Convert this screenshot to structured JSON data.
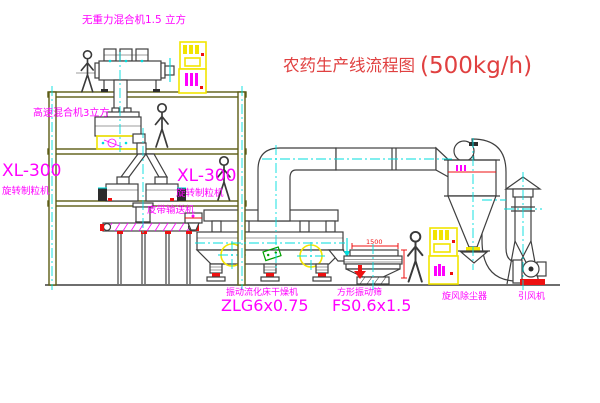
{
  "title": {
    "text_cn": "农药生产线流程图",
    "text_rate": "(500kg/h)"
  },
  "equipment_labels": {
    "top_mixer": "无重力混合机1.5 立方",
    "mid_mixer": "高速混合机3立方",
    "granulator_left_model": "XL-300",
    "granulator_left_name": "旋转制粒机",
    "granulator_center_model": "XL-300",
    "granulator_center_name": "旋转制粒机",
    "belt_conveyor": "皮带输送机",
    "dryer_name": "振动流化床干燥机",
    "dryer_model": "ZLG6x0.75",
    "sieve_name": "方形振动筛",
    "sieve_model": "FS0.6x1.5",
    "cyclone_name": "旋风除尘器",
    "fan_name": "引风机"
  },
  "dimensions": {
    "sieve_width": "1500"
  },
  "colors": {
    "background": "#ffffff",
    "line": "#3f3f3f",
    "building": "#5c5c14",
    "label": "#ff00ff",
    "title": "#e04040",
    "cad_yellow": "#f2e400",
    "centerline": "#00dede",
    "accent_red": "#ee1111",
    "accent_green": "#00a000"
  }
}
